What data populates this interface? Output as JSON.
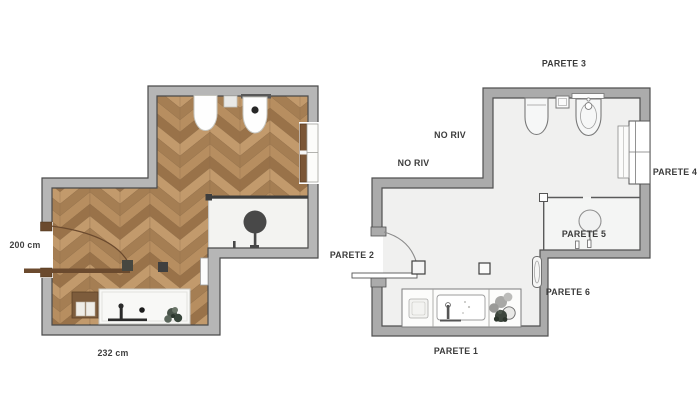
{
  "page": {
    "background": "#ffffff",
    "description": "Two bathroom floor plans side by side: a furnished render plan with herringbone wood floor (left) and a schematic plan with wall labels (right)"
  },
  "left_plan": {
    "name": "Furnished bathroom floor plan",
    "dimension_height": "200 cm",
    "dimension_width": "232 cm",
    "fixtures": [
      "toilet",
      "bidet",
      "flush-plate",
      "shelf",
      "shower-head",
      "shower-glass",
      "bathtub",
      "bathtub-faucet",
      "drain",
      "vanity-cabinet",
      "plant",
      "towel-radiator",
      "entry-door",
      "window",
      "floor-drain"
    ],
    "colors": {
      "wall_fill": "#b6b6b6",
      "wall_outline": "#4a4a4a",
      "wood_tones": [
        "#c29a6c",
        "#a57e53",
        "#b78e60",
        "#997249"
      ],
      "wood_seam": "#8f6c48",
      "shower_floor": "#f3f3f1",
      "door_wood": "#6b4a2e",
      "fixture_dark": "#484848"
    }
  },
  "right_plan": {
    "name": "Schematic bathroom floor plan with wall labels",
    "wall_labels": {
      "parete_1": "PARETE 1",
      "parete_2": "PARETE 2",
      "parete_3": "PARETE 3",
      "parete_4": "PARETE 4",
      "parete_5": "PARETE 5",
      "parete_6": "PARETE 6"
    },
    "no_riv": [
      "NO RIV",
      "NO RIV"
    ],
    "fixtures": [
      "toilet",
      "cistern",
      "bidet",
      "shelf",
      "shower-head",
      "shower-glass",
      "bathtub",
      "vanity-cabinet",
      "plant",
      "towel-radiator",
      "entry-door",
      "window",
      "window-radiator",
      "floor-drain"
    ],
    "colors": {
      "wall_fill": "#ababab",
      "wall_outline": "#505050",
      "floor": "#f0f0ef",
      "line": "#7a7a7a",
      "text": "#3b3b3b"
    }
  }
}
